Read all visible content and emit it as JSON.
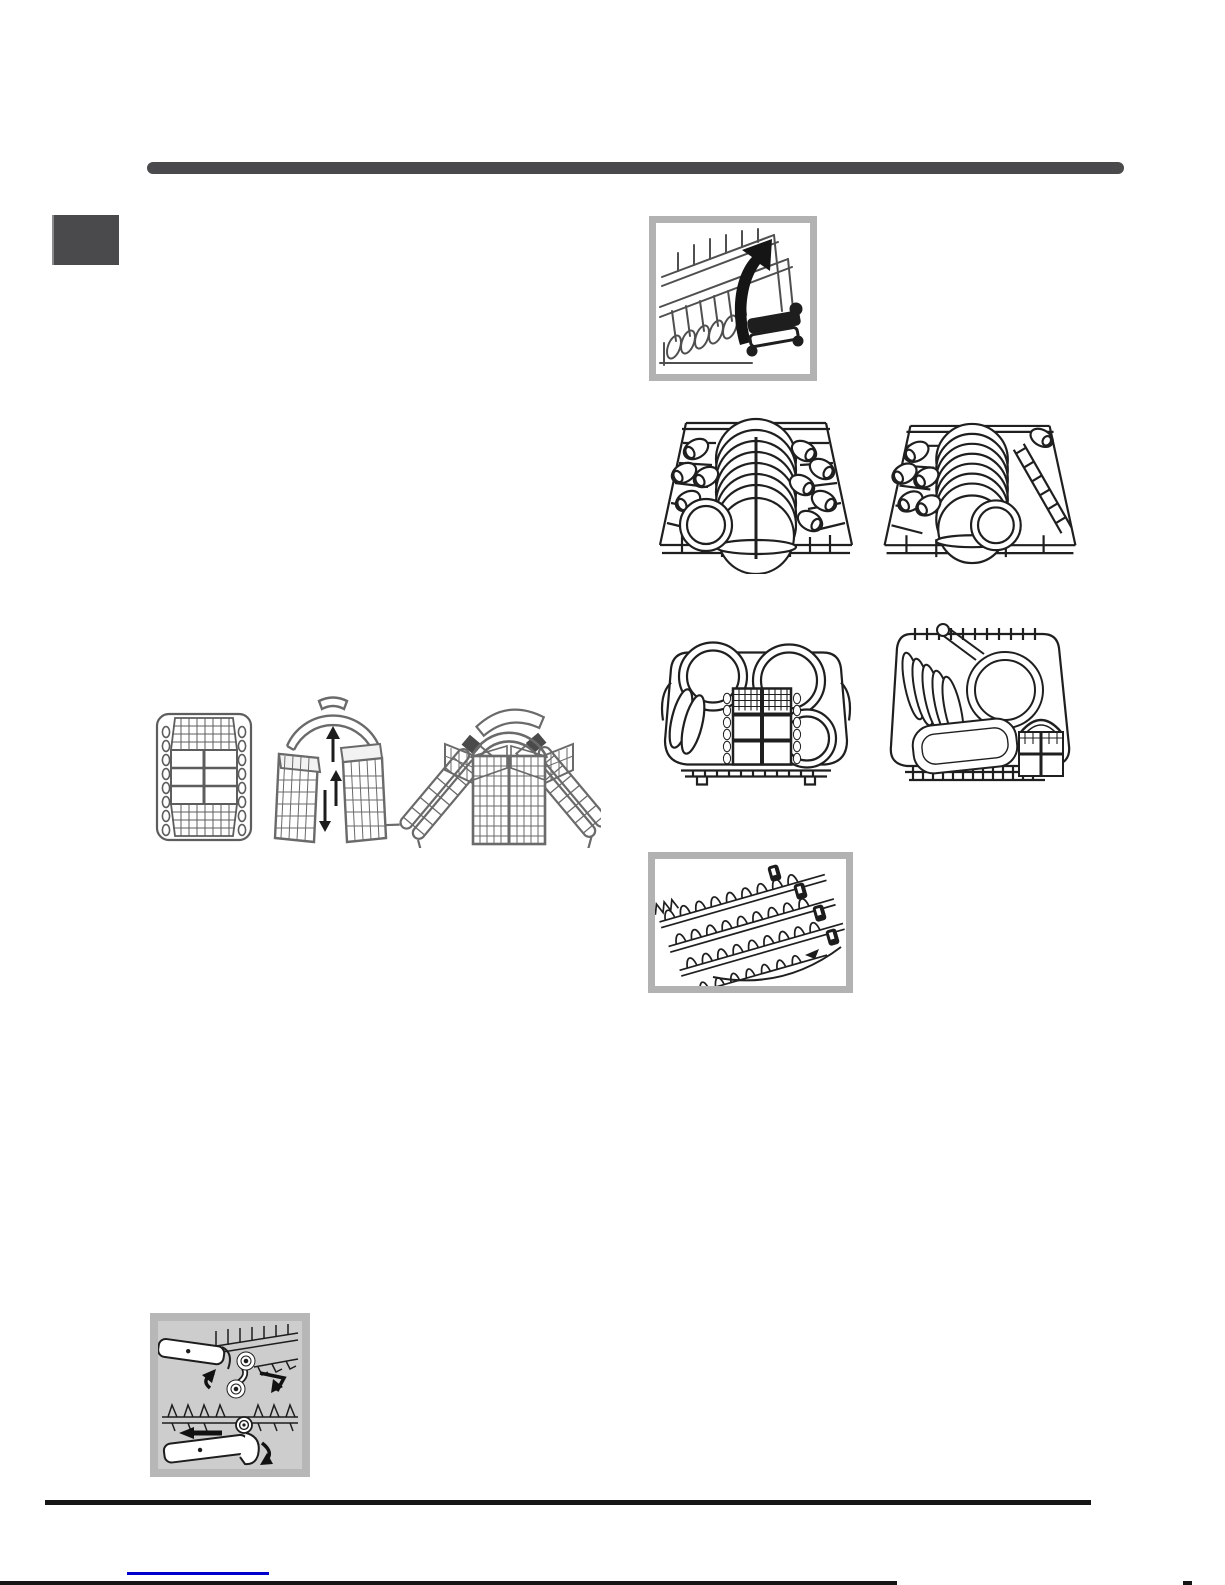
{
  "colors": {
    "page_bg": "#ffffff",
    "accent_gray": "#4a4a4c",
    "frame_gray": "#b2b2b2",
    "panel_fill": "#cdcdcd",
    "panel_border": "#b7b7b7",
    "line_art": "#2a2a2a",
    "rule_black": "#161616",
    "link_blue": "#0000cd"
  },
  "header": {
    "section_bar_color": "#4a4a4c",
    "chapter_block_color": "#4a4a4c"
  },
  "figures": {
    "rack_rail": {
      "label": "upper rack rail with fold-up arrow"
    },
    "upper_rack_left": {
      "label": "upper rack loaded with cups and plates, view 1"
    },
    "upper_rack_right": {
      "label": "upper rack loaded with cups and plates, view 2"
    },
    "lower_rack_left": {
      "label": "lower rack loaded with plates and cutlery basket"
    },
    "lower_rack_right": {
      "label": "lower rack loaded with plates, pan and casserole"
    },
    "tines": {
      "label": "foldable plate supports"
    },
    "cutlery_top_view": {
      "label": "modular cutlery basket top view"
    },
    "cutlery_halves": {
      "label": "cutlery basket sliding halves with handle"
    },
    "cutlery_assembled": {
      "label": "cutlery basket with tilted side gratings"
    },
    "height_adjust": {
      "label": "upper rack height adjustment mechanism"
    }
  }
}
